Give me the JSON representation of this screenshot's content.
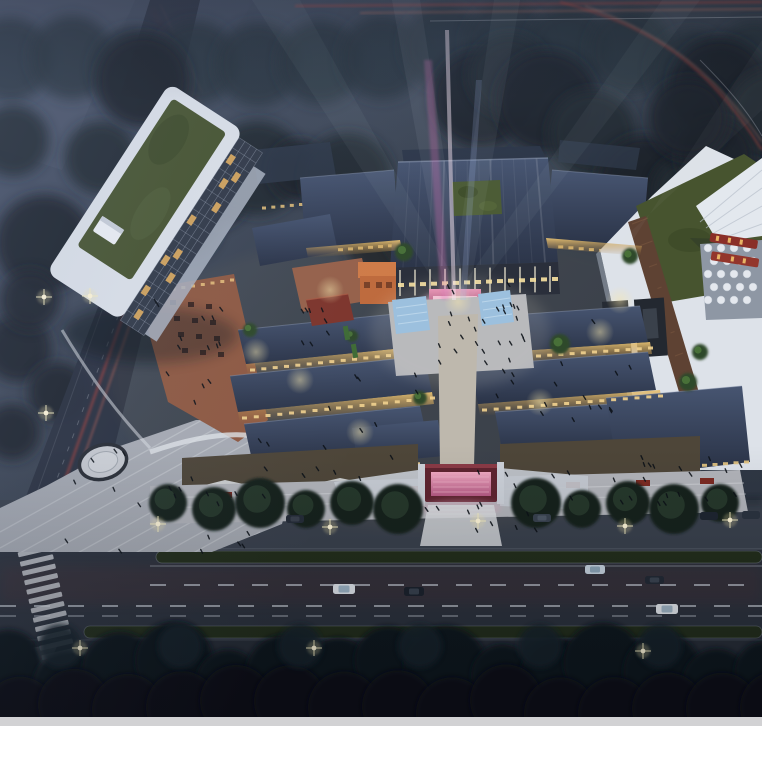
{
  "meta": {
    "alt": "Aerial night-time architectural rendering of a traditional-style commercial block: dark tiled roofs around lit pedestrian lanes, a white tower with rooftop garden on the left, a central gate hall with magenta searchlight beams, twin reflecting pools, a red entrance gate, a rooftop tent with umbrella deck on the right, and a boulevard with red traffic light trails in front."
  },
  "palette": {
    "sky_top": "#4a546a",
    "sky_mid": "#39424f",
    "sky_low": "#2b3340",
    "tree_dark": "#1a222b",
    "tree_deep": "#0e151b",
    "roof_hi": "#475571",
    "roof_lo": "#2b3448",
    "warm_window": "#f3dd9a",
    "facade_dark": "#4e4639",
    "brick": "#8f5a43",
    "plaza": "#b2b4ba",
    "plaza_left": "#a7abb3",
    "white_wall": "#dde2e9",
    "lawn": "#47542f",
    "pool": "#9cc0de",
    "stage_pink": "#cf6f9f",
    "gate_red": "#5f2430",
    "gate_glow": "#e490ac",
    "trail_red": "#c1453a",
    "trail_bright": "#e8705a",
    "median_green": "#232e1b",
    "road": "#2c323d",
    "sidewalk": "#3a414d",
    "sidewalk_low": "#272d37",
    "orange": "#bf6a3c",
    "pavilion_red": "#7e352c",
    "tent_white": "#e3e8ee",
    "path_brown": "#5e4233",
    "star": "#fff6d8",
    "footer_gray": "#d2d2d4"
  },
  "scene": {
    "regions": [
      "hazy city towers",
      "forest canopy",
      "left avenue with light trails",
      "white tower with rooftop garden",
      "terracotta dining terraces",
      "traditional tiled roof blocks",
      "central gate hall with rooftop courtyard",
      "stage with magenta searchlights",
      "twin reflecting pools",
      "lantern-lit shopping lanes",
      "red entrance gate",
      "front promenade and steps",
      "circular plaza medallion",
      "white rooftop tent and umbrella deck",
      "billboard wall",
      "boulevard with traffic light trails",
      "street trees and parked cars",
      "zebra crosswalk"
    ]
  }
}
